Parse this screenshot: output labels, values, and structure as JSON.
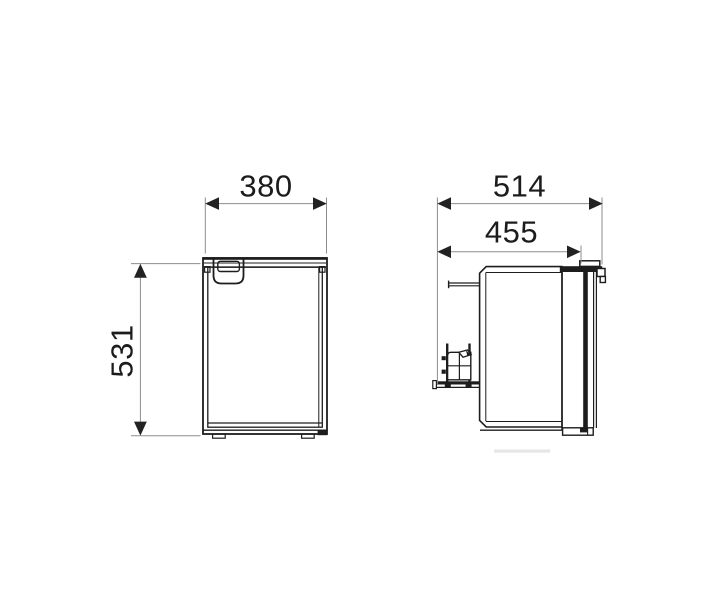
{
  "drawing": {
    "type": "technical-dimension-drawing",
    "subject": "compact refrigerator, front and side orthographic views",
    "colors": {
      "background": "#ffffff",
      "line": "#1d1d1d",
      "dimension_line": "#8d8d8d",
      "shadow": "#e6e6e6"
    },
    "views": {
      "front": {
        "name": "front-view",
        "width": "380",
        "height": "531"
      },
      "side": {
        "name": "side-view",
        "overall_depth": "514",
        "body_depth": "455"
      }
    }
  }
}
